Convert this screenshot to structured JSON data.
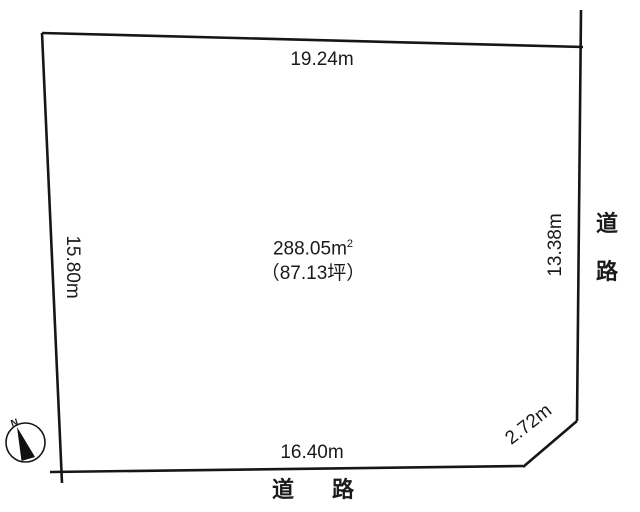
{
  "canvas": {
    "background": "#ffffff",
    "line_color": "#161616",
    "text_color": "#1a1a1a"
  },
  "plot": {
    "area_value": "288.05",
    "area_unit_base": "m",
    "area_unit_sup": "2",
    "area_tsubo": "（87.13坪）",
    "dimensions": {
      "top": "19.24m",
      "left": "15.80m",
      "right": "13.38m",
      "bottom": "16.40m",
      "corner_cut": "2.72m"
    }
  },
  "roads": {
    "right": {
      "char1": "道",
      "char2": "路"
    },
    "bottom": {
      "char1": "道",
      "char2": "路"
    }
  },
  "compass": {
    "north_label": "N"
  }
}
